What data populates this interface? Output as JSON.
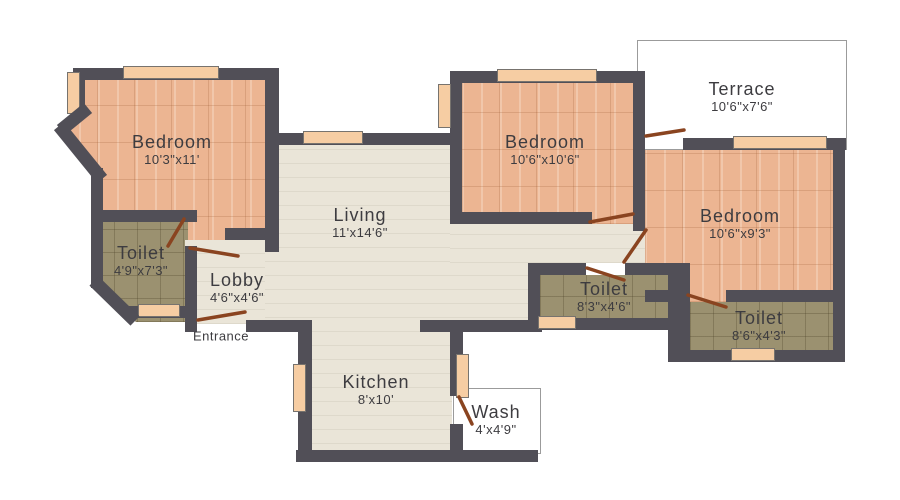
{
  "colors": {
    "bg": "#ffffff",
    "wall": "#514f57",
    "bedroom_floor": "#ecb592",
    "cream_floor": "#eae5d8",
    "toilet_floor": "#9b9170",
    "terrace_floor": "#f0e2c8",
    "window_fill": "#f6cda3",
    "door_leaf": "#8a4420",
    "label_text": "#3d3c40",
    "frame_line": "#9b9b9b"
  },
  "rooms": [
    {
      "id": "bedroom-top-left",
      "name": "Bedroom",
      "dims": "10'3\"x11'"
    },
    {
      "id": "toilet-left",
      "name": "Toilet",
      "dims": "4'9\"x7'3\""
    },
    {
      "id": "lobby",
      "name": "Lobby",
      "dims": "4'6\"x4'6\""
    },
    {
      "id": "living",
      "name": "Living",
      "dims": "11'x14'6\""
    },
    {
      "id": "kitchen",
      "name": "Kitchen",
      "dims": "8'x10'"
    },
    {
      "id": "wash",
      "name": "Wash",
      "dims": "4'x4'9\""
    },
    {
      "id": "bedroom-middle",
      "name": "Bedroom",
      "dims": "10'6\"x10'6\""
    },
    {
      "id": "terrace",
      "name": "Terrace",
      "dims": "10'6\"x7'6\""
    },
    {
      "id": "bedroom-right",
      "name": "Bedroom",
      "dims": "10'6\"x9'3\""
    },
    {
      "id": "toilet-center",
      "name": "Toilet",
      "dims": "8'3\"x4'6\""
    },
    {
      "id": "toilet-right",
      "name": "Toilet",
      "dims": "8'6\"x4'3\""
    }
  ],
  "entrance": {
    "label": "Entrance"
  }
}
